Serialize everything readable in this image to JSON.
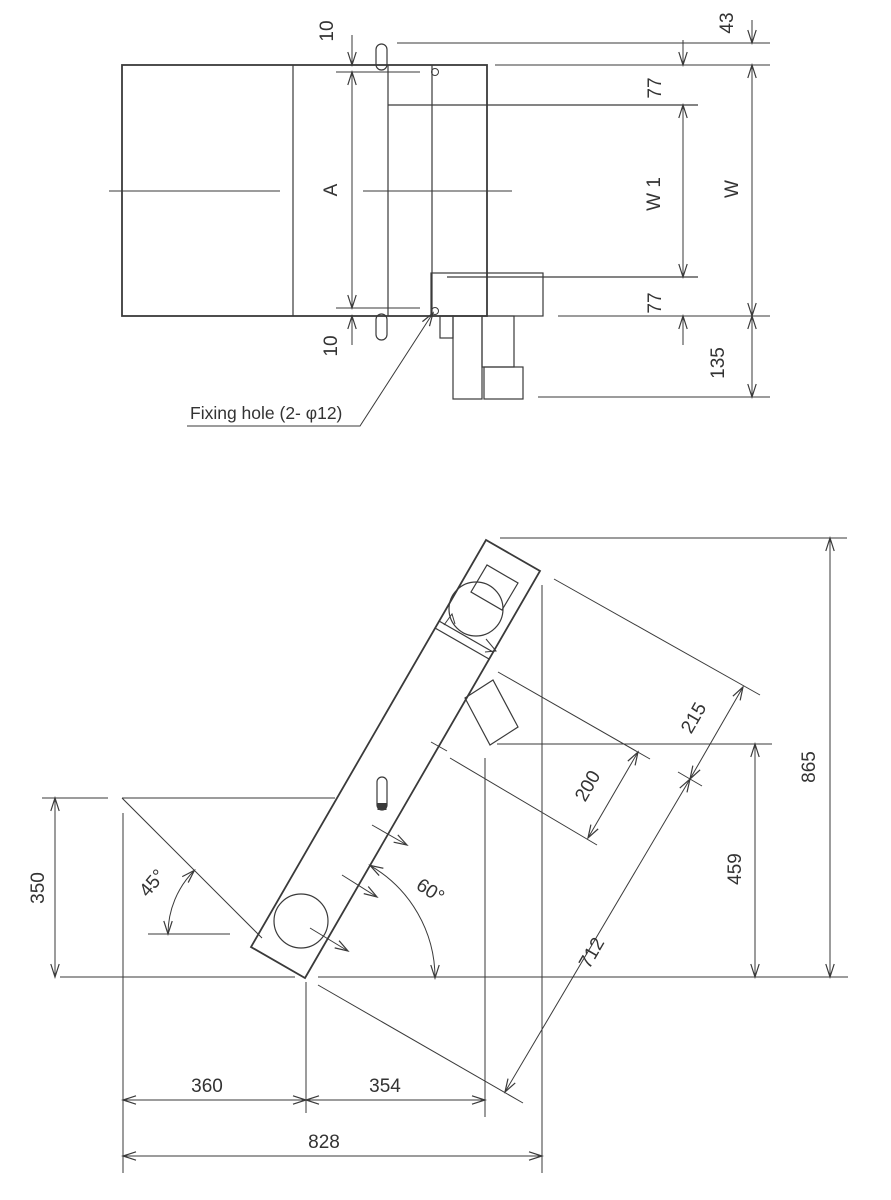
{
  "top_view": {
    "dim_10_top": "10",
    "dim_a": "A",
    "dim_10_bottom": "10",
    "dim_43": "43",
    "dim_77_top": "77",
    "dim_w1": "W 1",
    "dim_w": "W",
    "dim_77_bottom": "77",
    "dim_135": "135",
    "fixing_hole_note": "Fixing hole (2- φ12)"
  },
  "side_view": {
    "dim_350": "350",
    "angle_45": "45°",
    "angle_60": "60°",
    "dim_360": "360",
    "dim_354": "354",
    "dim_828": "828",
    "dim_712": "712",
    "dim_200": "200",
    "dim_215": "215",
    "dim_459": "459",
    "dim_865": "865"
  },
  "colors": {
    "line": "#3a3a3a",
    "background": "#ffffff",
    "text": "#333333"
  }
}
